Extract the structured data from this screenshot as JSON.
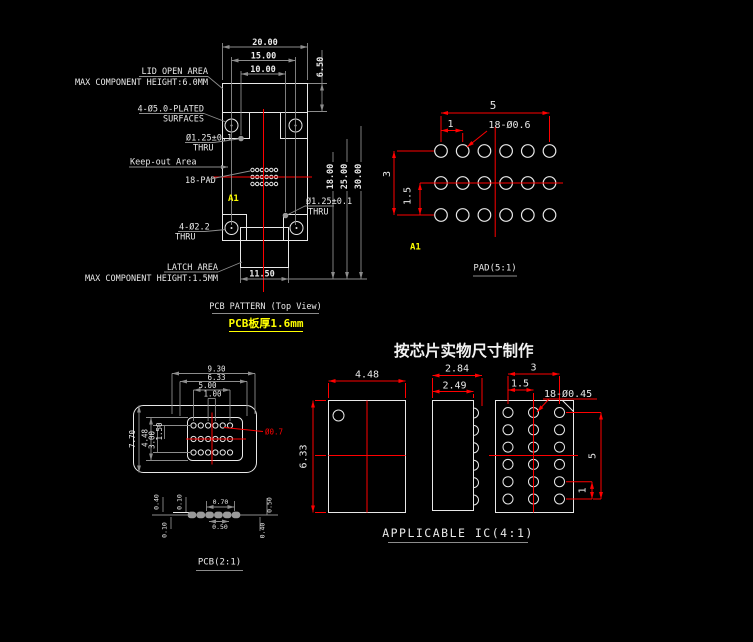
{
  "colors": {
    "background": "#000000",
    "line_white": "#e8e8e8",
    "line_gray": "#8c8c8c",
    "dimension_red": "#ff0000",
    "accent_yellow": "#ffff00"
  },
  "note": "按芯片实物尺寸制作",
  "pcb_pattern": {
    "title": "PCB PATTERN (Top View)",
    "subtitle": "PCB板厚1.6mm",
    "dims": {
      "w20": "20.00",
      "w15": "15.00",
      "w10": "10.00",
      "h650": "6.50",
      "h18": "18.00",
      "h25": "25.00",
      "h30": "30.00",
      "w1150": "11.50"
    },
    "labels": {
      "lid_open_area": "LID OPEN AREA",
      "lid_max_height": "MAX COMPONENT HEIGHT:6.0MM",
      "plated_1": "4-Ø5.0-PLATED",
      "plated_2": "SURFACES",
      "hole_top": "Ø1.25±0.1",
      "hole_top_thru": "THRU",
      "keep_out": "Keep-out Area",
      "pad_count": "18-PAD",
      "a1": "A1",
      "hole_right": "Ø1.25±0.1",
      "hole_right_thru": "THRU",
      "hole_corner": "4-Ø2.2",
      "hole_corner_thru": "THRU",
      "latch_area": "LATCH AREA",
      "latch_max_height": "MAX COMPONENT HEIGHT:1.5MM"
    }
  },
  "pad_view": {
    "title": "PAD(5:1)",
    "a1": "A1",
    "hole_label": "18-Ø0.6",
    "dims": {
      "w5": "5",
      "w1": "1",
      "h3": "3",
      "h15": "1.5"
    }
  },
  "pcb_view": {
    "title": "PCB(2:1)",
    "pad_dia": "Ø0.7",
    "dims_top": {
      "d930": "9.30",
      "d633": "6.33",
      "d500": "5.00",
      "d100": "1.00"
    },
    "dims_left": {
      "d770": "7.70",
      "d448": "4.48",
      "d300": "3.00",
      "d150": "1.50"
    },
    "section": {
      "t040": "0.40",
      "t010": "0.10",
      "t070": "0.70",
      "t050": "0.50",
      "b010": "0.10",
      "b050": "0.50",
      "b040": "0.40"
    }
  },
  "ic_view": {
    "title": "APPLICABLE IC(4:1)",
    "front": {
      "w": "4.48",
      "h": "6.33"
    },
    "side": {
      "w_outer": "2.84",
      "w_body": "2.49"
    },
    "bump": {
      "w3": "3",
      "w15": "1.5",
      "label": "18-Ø0.45",
      "h5": "5",
      "h1": "1"
    }
  }
}
